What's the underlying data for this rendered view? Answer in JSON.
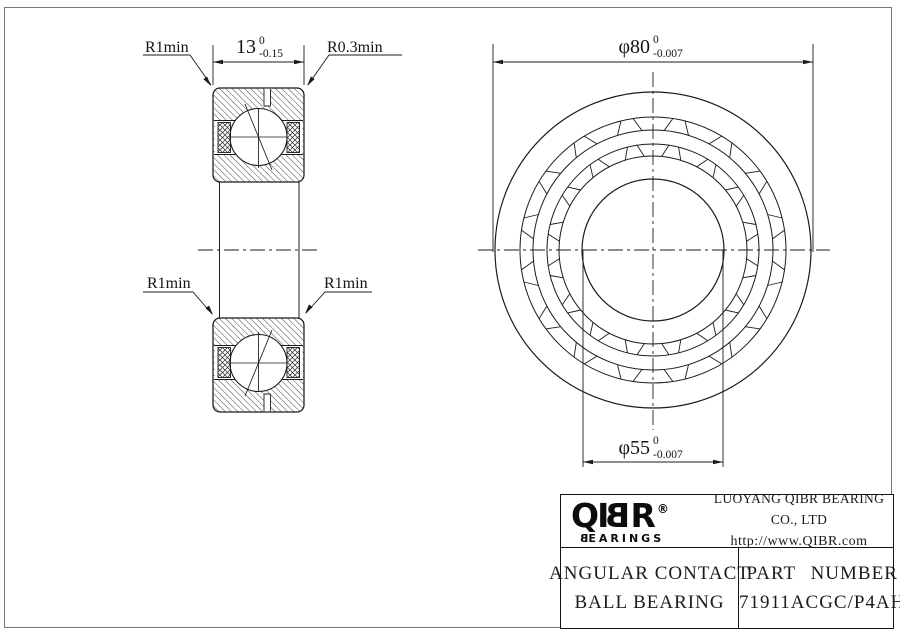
{
  "section_view": {
    "width_dim": {
      "value": "13",
      "tol_upper": "0",
      "tol_lower": "-0.15"
    },
    "corner_labels": {
      "top_left": "R1min",
      "top_right": "R0.3min",
      "bottom_left": "R1min",
      "bottom_right": "R1min"
    }
  },
  "front_view": {
    "outer_dia_dim": {
      "value": "φ80",
      "tol_upper": "0",
      "tol_lower": "-0.007"
    },
    "bore_dia_dim": {
      "value": "φ55",
      "tol_upper": "0",
      "tol_lower": "-0.007"
    }
  },
  "title_block": {
    "logo": {
      "l1": "Q",
      "l2": "I",
      "l3": "B",
      "l4": "R",
      "registered": "®",
      "sub_first": "B",
      "sub_rest": "EARINGS"
    },
    "company": "LUOYANG QIBR BEARING CO., LTD",
    "website": "http://www.QIBR.com",
    "product_line1": "ANGULAR CONTACT",
    "product_line2": "BALL BEARING",
    "part_number_label": "PART NUMBER",
    "part_number": "71911ACGC/P4AH"
  },
  "colors": {
    "line": "#1b1b1b",
    "frame": "#787878",
    "background": "#ffffff"
  }
}
